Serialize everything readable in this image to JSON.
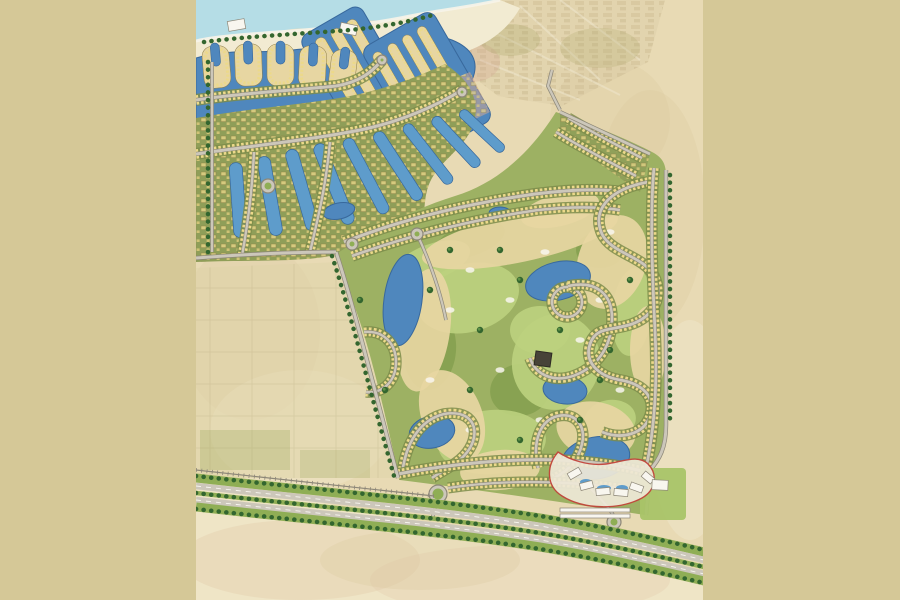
{
  "meta": {
    "description": "Master plan map of a coastal golf-resort community (no visible text labels in the image)",
    "no_visible_text": true
  },
  "palette": {
    "letterbox": "#d5c897",
    "mapbase": "#e8dab4",
    "desert_light": "#f0e7cb",
    "blotch_pink": "#dfc3a3",
    "blotch_tan": "#d9c9a0",
    "sea": "#b5dde6",
    "surf": "#f7f4e9",
    "beach": "#f2ebd2",
    "water": "#4f87bd",
    "water_edge": "#38689c",
    "pool": "#5e9ccb",
    "olive": "#8f9e58",
    "olive_dark": "#7c8c4a",
    "green": "#9db163",
    "fairway": "#bdd17e",
    "rough": "#85a04f",
    "sand": "#e7d6a2",
    "sand_light": "#efe3bb",
    "road": "#ccc7ba",
    "road_dark": "#8d8778",
    "house": "#ecd98a",
    "house_edge": "#8f7f45",
    "tree": "#33662f",
    "median": "#8fae55",
    "white": "#f8f6ef",
    "red": "#c4423a",
    "ghost": "#d8c8a2",
    "clubhouse": "#474338",
    "lawn": "#a9c468",
    "pink_block": "#d4a795"
  },
  "blotches": [
    {
      "cx": 300,
      "cy": 560,
      "rx": 120,
      "ry": 40,
      "k": "blotch_pink",
      "o": 0.3
    },
    {
      "cx": 520,
      "cy": 580,
      "rx": 150,
      "ry": 35,
      "k": "blotch_pink",
      "o": 0.25
    },
    {
      "cx": 250,
      "cy": 330,
      "rx": 70,
      "ry": 90,
      "k": "blotch_tan",
      "o": 0.25
    },
    {
      "cx": 650,
      "cy": 210,
      "rx": 55,
      "ry": 120,
      "k": "blotch_tan",
      "o": 0.3
    },
    {
      "cx": 690,
      "cy": 430,
      "rx": 40,
      "ry": 110,
      "k": "desert_light",
      "o": 0.45
    },
    {
      "cx": 300,
      "cy": 430,
      "rx": 90,
      "ry": 60,
      "k": "desert_light",
      "o": 0.4
    },
    {
      "cx": 610,
      "cy": 120,
      "rx": 60,
      "ry": 60,
      "k": "blotch_tan",
      "o": 0.3
    },
    {
      "cx": 420,
      "cy": 560,
      "rx": 100,
      "ry": 30,
      "k": "blotch_tan",
      "o": 0.3
    }
  ],
  "marina": {
    "fingers": [
      {
        "x": 203,
        "y": 46,
        "w": 27,
        "h": 42,
        "rot": -5
      },
      {
        "x": 235,
        "y": 44,
        "w": 27,
        "h": 42,
        "rot": -2
      },
      {
        "x": 267,
        "y": 44,
        "w": 27,
        "h": 42,
        "rot": 0
      },
      {
        "x": 299,
        "y": 46,
        "w": 27,
        "h": 42,
        "rot": 3
      },
      {
        "x": 330,
        "y": 50,
        "w": 26,
        "h": 40,
        "rot": 7
      }
    ],
    "basins": [
      {
        "cx": 358,
        "cy": 72,
        "rot": -30,
        "bw": 70,
        "bh": 118,
        "strips": [
          -23,
          -5,
          13
        ],
        "sw": 11,
        "sh": 98
      },
      {
        "cx": 427,
        "cy": 84,
        "rot": -30,
        "bw": 82,
        "bh": 126,
        "strips": [
          -34,
          -17,
          0,
          17
        ],
        "sw": 10,
        "sh": 106
      }
    ],
    "channels": [
      {
        "cx": 238,
        "cy": 200,
        "rot": -4,
        "w": 13,
        "h": 75
      },
      {
        "cx": 270,
        "cy": 196,
        "rot": -10,
        "w": 13,
        "h": 80
      },
      {
        "cx": 302,
        "cy": 190,
        "rot": -16,
        "w": 13,
        "h": 84
      },
      {
        "cx": 334,
        "cy": 184,
        "rot": -22,
        "w": 13,
        "h": 86
      },
      {
        "cx": 366,
        "cy": 176,
        "rot": -28,
        "w": 12,
        "h": 84
      },
      {
        "cx": 398,
        "cy": 166,
        "rot": -33,
        "w": 12,
        "h": 80
      },
      {
        "cx": 428,
        "cy": 154,
        "rot": -38,
        "w": 11,
        "h": 74
      },
      {
        "cx": 456,
        "cy": 142,
        "rot": -43,
        "w": 11,
        "h": 66
      },
      {
        "cx": 482,
        "cy": 131,
        "rot": -47,
        "w": 10,
        "h": 58
      }
    ]
  },
  "golf": {
    "fairways": [
      {
        "cx": 468,
        "cy": 298,
        "rx": 52,
        "ry": 34,
        "rot": -15
      },
      {
        "cx": 556,
        "cy": 362,
        "rx": 44,
        "ry": 48,
        "rot": 10
      },
      {
        "cx": 492,
        "cy": 442,
        "rx": 54,
        "ry": 32,
        "rot": -5
      },
      {
        "cx": 432,
        "cy": 262,
        "rx": 40,
        "ry": 18,
        "rot": -20
      },
      {
        "cx": 632,
        "cy": 312,
        "rx": 20,
        "ry": 44,
        "rot": 5
      },
      {
        "cx": 540,
        "cy": 330,
        "rx": 30,
        "ry": 24,
        "rot": 0
      },
      {
        "cx": 610,
        "cy": 420,
        "rx": 26,
        "ry": 20,
        "rot": -10
      }
    ],
    "rough": [
      {
        "cx": 430,
        "cy": 350,
        "rx": 26,
        "ry": 40,
        "rot": 5
      },
      {
        "cx": 520,
        "cy": 390,
        "rx": 30,
        "ry": 26,
        "rot": -10
      },
      {
        "cx": 600,
        "cy": 250,
        "rx": 24,
        "ry": 18,
        "rot": 0
      },
      {
        "cx": 470,
        "cy": 240,
        "rx": 36,
        "ry": 16,
        "rot": -18
      }
    ],
    "waste": [
      {
        "cx": 520,
        "cy": 238,
        "rx": 100,
        "ry": 24,
        "rot": -12
      },
      {
        "cx": 612,
        "cy": 262,
        "rx": 34,
        "ry": 48,
        "rot": 18
      },
      {
        "cx": 424,
        "cy": 330,
        "rx": 26,
        "ry": 62,
        "rot": 8
      },
      {
        "cx": 452,
        "cy": 416,
        "rx": 30,
        "ry": 48,
        "rot": -22
      },
      {
        "cx": 596,
        "cy": 430,
        "rx": 40,
        "ry": 28,
        "rot": 12
      },
      {
        "cx": 648,
        "cy": 350,
        "rx": 18,
        "ry": 44,
        "rot": 0
      },
      {
        "cx": 500,
        "cy": 470,
        "rx": 40,
        "ry": 20,
        "rot": -5
      },
      {
        "cx": 560,
        "cy": 210,
        "rx": 40,
        "ry": 16,
        "rot": -14
      }
    ],
    "lakes": [
      {
        "cx": 403,
        "cy": 300,
        "rx": 19,
        "ry": 46,
        "rot": 8
      },
      {
        "cx": 432,
        "cy": 432,
        "rx": 23,
        "ry": 16,
        "rot": -12
      },
      {
        "cx": 558,
        "cy": 281,
        "rx": 33,
        "ry": 19,
        "rot": -14
      },
      {
        "cx": 500,
        "cy": 213,
        "rx": 11,
        "ry": 6,
        "rot": 0
      },
      {
        "cx": 565,
        "cy": 390,
        "rx": 22,
        "ry": 14,
        "rot": 6
      },
      {
        "cx": 596,
        "cy": 458,
        "rx": 34,
        "ry": 21,
        "rot": -10
      },
      {
        "cx": 339,
        "cy": 211,
        "rx": 16,
        "ry": 8,
        "rot": -12
      }
    ],
    "specks": [
      {
        "cx": 470,
        "cy": 270
      },
      {
        "cx": 510,
        "cy": 300
      },
      {
        "cx": 545,
        "cy": 252
      },
      {
        "cx": 600,
        "cy": 300
      },
      {
        "cx": 430,
        "cy": 380
      },
      {
        "cx": 470,
        "cy": 430
      },
      {
        "cx": 540,
        "cy": 420
      },
      {
        "cx": 580,
        "cy": 340
      },
      {
        "cx": 620,
        "cy": 390
      },
      {
        "cx": 500,
        "cy": 370
      },
      {
        "cx": 450,
        "cy": 310
      },
      {
        "cx": 610,
        "cy": 232
      }
    ],
    "trees": [
      {
        "cx": 430,
        "cy": 290
      },
      {
        "cx": 480,
        "cy": 330
      },
      {
        "cx": 520,
        "cy": 280
      },
      {
        "cx": 560,
        "cy": 330
      },
      {
        "cx": 610,
        "cy": 350
      },
      {
        "cx": 470,
        "cy": 390
      },
      {
        "cx": 520,
        "cy": 440
      },
      {
        "cx": 580,
        "cy": 420
      },
      {
        "cx": 450,
        "cy": 250
      },
      {
        "cx": 630,
        "cy": 280
      },
      {
        "cx": 600,
        "cy": 380
      },
      {
        "cx": 500,
        "cy": 250
      },
      {
        "cx": 360,
        "cy": 300
      },
      {
        "cx": 385,
        "cy": 390
      }
    ]
  },
  "streets": [
    {
      "d": "M196,100 C250,92 300,90 336,86 C360,82 372,72 382,60",
      "w": 3
    },
    {
      "d": "M196,154 C250,146 310,140 360,130 C400,122 436,106 462,90",
      "w": 3
    },
    {
      "d": "M254,152 C252,192 248,222 242,256",
      "w": 2.4
    },
    {
      "d": "M330,142 C326,186 318,218 310,252",
      "w": 2.4
    },
    {
      "d": "M568,118 C592,132 618,146 642,158",
      "w": 2.4
    },
    {
      "d": "M556,132 C582,148 610,162 636,176",
      "w": 2.4
    },
    {
      "d": "M344,242 C400,220 465,204 535,194 C568,190 598,188 622,192",
      "w": 3
    },
    {
      "d": "M352,256 C408,236 470,220 538,210 C566,207 594,206 620,210",
      "w": 2.6
    },
    {
      "d": "M552,302 a15,15 0 1 1 30,0 a15,15 0 1 1 -30,0",
      "w": 2.4
    },
    {
      "d": "M568,286 C596,280 612,294 612,318 C612,344 600,364 578,374 C556,384 536,376 530,358",
      "w": 2.6
    },
    {
      "d": "M648,182 C606,190 592,212 602,234 C612,254 644,256 654,276 C664,296 654,316 632,324 C612,331 596,326 590,344 C584,362 598,376 620,380 C644,384 656,398 650,416 C644,434 622,440 602,432",
      "w": 2.8
    },
    {
      "d": "M402,474 C406,442 420,420 444,414 C468,410 480,424 472,444 C464,462 446,468 432,478",
      "w": 2.6
    },
    {
      "d": "M538,468 C532,442 540,420 558,416 C576,412 586,426 582,444 C578,462 566,472 554,478",
      "w": 2.6
    },
    {
      "d": "M364,332 C384,330 396,344 396,362 C396,382 382,394 366,392",
      "w": 2.4
    },
    {
      "d": "M398,474 C450,464 510,458 560,460 C595,462 625,466 645,472",
      "w": 3
    },
    {
      "d": "M654,168 C650,210 652,270 655,330 C658,390 653,436 646,468",
      "w": 2.8
    },
    {
      "d": "M448,488 C500,480 560,480 620,488",
      "w": 2.2
    }
  ],
  "roads": [
    {
      "d": "M336,252 C352,300 372,380 398,478",
      "w": 3
    },
    {
      "d": "M666,170 L666,425 C666,448 659,460 650,470 L646,515",
      "w": 3
    },
    {
      "d": "M560,110 L548,86 L552,70",
      "w": 2.4
    },
    {
      "d": "M196,258 C250,254 300,252 336,252",
      "w": 3
    },
    {
      "d": "M212,62 L212,252",
      "w": 2.4
    },
    {
      "d": "M560,112 L650,154",
      "w": 2.8
    },
    {
      "d": "M438,494 C436,504 434,512 432,520",
      "w": 2.4
    },
    {
      "d": "M590,488 C600,498 610,508 616,520",
      "w": 2.2
    },
    {
      "d": "M417,234 C430,262 440,290 446,320",
      "w": 2.2
    }
  ],
  "roundabouts": [
    {
      "cx": 268,
      "cy": 186,
      "r": 7
    },
    {
      "cx": 352,
      "cy": 244,
      "r": 6
    },
    {
      "cx": 417,
      "cy": 234,
      "r": 6
    },
    {
      "cx": 438,
      "cy": 494,
      "r": 9
    },
    {
      "cx": 614,
      "cy": 522,
      "r": 7
    },
    {
      "cx": 462,
      "cy": 92,
      "r": 5
    },
    {
      "cx": 382,
      "cy": 60,
      "r": 5
    }
  ],
  "treelines": [
    {
      "d": "M204,42 C250,36 300,34 350,30 C380,27 410,22 436,14"
    },
    {
      "d": "M208,62 L208,252"
    },
    {
      "d": "M332,256 C348,304 368,384 394,476"
    },
    {
      "d": "M670,175 L670,420"
    },
    {
      "d": "M196,476 C320,490 440,500 540,516 C600,526 662,540 704,550"
    },
    {
      "d": "M196,509 C320,523 440,533 540,549 C600,559 662,573 704,583"
    },
    {
      "d": "M196,493 C320,507 440,517 540,533 C600,543 662,557 704,567"
    }
  ],
  "highway": [
    {
      "d": "M196,478 C320,492 440,502 540,518 C600,528 662,542 704,552",
      "k": "median",
      "w": 9
    },
    {
      "d": "M196,486 C320,500 440,510 540,526 C600,536 662,550 704,560",
      "k": "road",
      "w": 6.5
    },
    {
      "d": "M196,486 C320,500 440,510 540,526 C600,536 662,550 704,560",
      "k": "white",
      "w": 0.9,
      "dash": "5 5"
    },
    {
      "d": "M196,493 C320,507 440,517 540,533 C600,543 662,557 704,567",
      "k": "median",
      "w": 4.5
    },
    {
      "d": "M196,500 C320,514 440,524 540,540 C600,550 662,564 704,574",
      "k": "road",
      "w": 6.5
    },
    {
      "d": "M196,500 C320,514 440,524 540,540 C600,550 662,564 704,574",
      "k": "white",
      "w": 0.9,
      "dash": "5 5"
    },
    {
      "d": "M196,507 C320,521 440,531 540,547 C600,557 662,571 704,581",
      "k": "median",
      "w": 9
    },
    {
      "d": "M196,470 C300,482 380,490 434,496",
      "k": "road_dark",
      "w": 1.2
    },
    {
      "d": "M196,470 C300,482 380,490 434,496",
      "k": "road_dark",
      "w": 4,
      "dash": "0.8 4.5"
    }
  ],
  "buildings": [
    {
      "x": 228,
      "y": 20,
      "w": 17,
      "h": 10,
      "rot": -10
    },
    {
      "x": 340,
      "y": 24,
      "w": 17,
      "h": 10,
      "rot": 12
    },
    {
      "x": 568,
      "y": 470,
      "w": 13,
      "h": 7,
      "rot": -30
    },
    {
      "x": 580,
      "y": 482,
      "w": 13,
      "h": 7,
      "rot": -15
    },
    {
      "x": 596,
      "y": 488,
      "w": 14,
      "h": 7,
      "rot": -5
    },
    {
      "x": 614,
      "y": 489,
      "w": 14,
      "h": 7,
      "rot": 5
    },
    {
      "x": 630,
      "y": 484,
      "w": 13,
      "h": 7,
      "rot": 20
    },
    {
      "x": 642,
      "y": 474,
      "w": 12,
      "h": 7,
      "rot": 40
    },
    {
      "x": 652,
      "y": 480,
      "w": 16,
      "h": 10,
      "rot": 3
    },
    {
      "x": 560,
      "y": 508,
      "w": 70,
      "h": 4,
      "rot": 0
    },
    {
      "x": 560,
      "y": 514,
      "w": 70,
      "h": 4,
      "rot": 0
    }
  ],
  "hotel_pools": [
    {
      "cx": 586,
      "cy": 482,
      "rx": 6,
      "ry": 3
    },
    {
      "cx": 604,
      "cy": 488,
      "rx": 7,
      "ry": 3
    },
    {
      "cx": 622,
      "cy": 488,
      "rx": 6,
      "ry": 3
    }
  ]
}
